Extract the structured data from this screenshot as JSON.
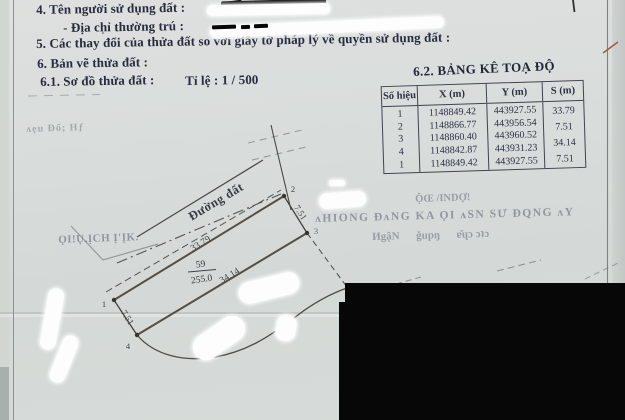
{
  "doc": {
    "section_4": "4. Tên người sử dụng đất :",
    "address_line": "- Địa chỉ thường trú :",
    "section_5": "5. Các thay đổi của thửa đất so với giấy tờ pháp lý về quyền sử dụng đất :",
    "section_6": "6. Bản vẽ thửa đất :",
    "section_6_1": "6.1. Sơ đồ thửa đất :",
    "scale": "Tỉ lệ : 1 / 500"
  },
  "table": {
    "title": "6.2. BẢNG KÊ TOẠ ĐỘ",
    "headers": [
      "Số hiệu",
      "X (m)",
      "Y (m)",
      "S (m)"
    ],
    "ids": [
      "1",
      "2",
      "3",
      "4",
      "1"
    ],
    "x_values": [
      "1148849.42",
      "1148866.77",
      "1148860.40",
      "1148842.87",
      "1148849.42"
    ],
    "y_values": [
      "443927.55",
      "443956.54",
      "443960.52",
      "443931.23",
      "443927.55"
    ],
    "s_values": [
      "33.79",
      "7.51",
      "34.14",
      "7.51"
    ]
  },
  "diagram": {
    "road_label": "Đường đất",
    "parcel_number": "59",
    "parcel_area": "255.0",
    "len_top": "33.79",
    "len_right": "7.51",
    "len_bottom": "34.14",
    "len_left": "7.51",
    "v1": "1",
    "v2": "2",
    "v3": "3",
    "v4": "4"
  },
  "bleed": {
    "left_1": "ʌẹu Đổ; Hƒ",
    "left_2": "ỌI!Ụ.ỊCH Ị'ỊK.",
    "right_1": "ỘŒ /INDỢ!",
    "right_2": "ʌHIONG ĐʌNG KA ỌI ʌSN SƯ ĐQNG ʌY",
    "right_3": "ИgậN      ǧupŋ      ɐ̆ɥɔ ɔʇɔ"
  },
  "colors": {
    "paper": "#d8dcda",
    "ink": "#272c3e",
    "table_line": "#3e4452",
    "diagram_line": "#564e45",
    "redaction": "#070707",
    "whiteout": "#fcfdfc",
    "red_mark": "#a35a48"
  }
}
